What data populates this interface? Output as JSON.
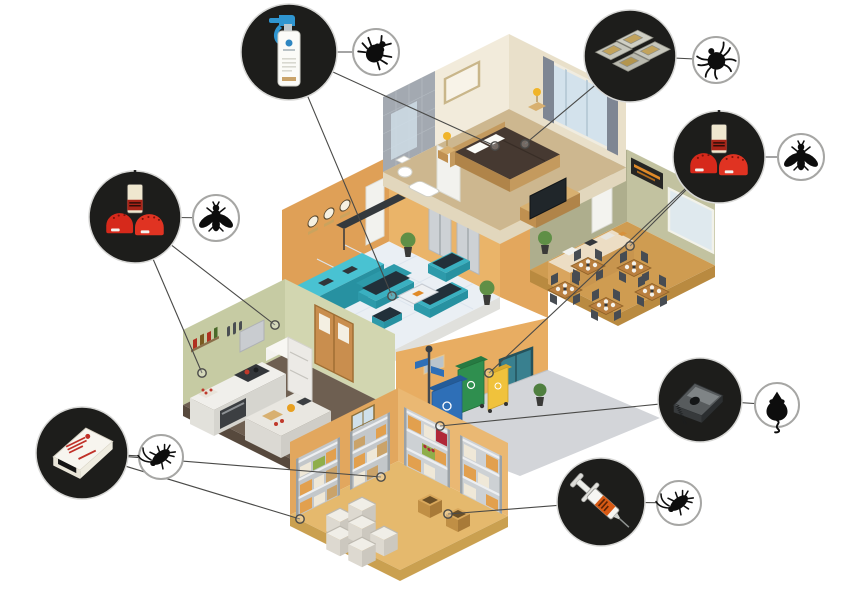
{
  "scene": {
    "kind": "isometric-pest-control-infographic",
    "background": "#ffffff",
    "line_color": "#4a4a48",
    "line_width": 1.1,
    "marker_radius": 4.2,
    "callout_style": {
      "fill": "#1d1d1b",
      "ring": "#d8d8d6",
      "ring_width": 1.5
    },
    "pest_circle_style": {
      "fill": "#ffffff",
      "stroke": "#a6a6a4",
      "stroke_width": 2,
      "glyph": "#0d0d0d"
    }
  },
  "callouts": [
    {
      "id": "bedbug-spray",
      "product": "spray",
      "product_name": "insecticide-trigger-spray-bottle",
      "pest": "bedbug",
      "pest_name": "bed-bug",
      "circle": {
        "cx": 289,
        "cy": 52,
        "r": 48
      },
      "pest_circle": {
        "cx": 376,
        "cy": 52,
        "r": 23
      },
      "targets": [
        [
          495,
          146
        ],
        [
          392,
          296
        ]
      ]
    },
    {
      "id": "bait-station-trays",
      "product": "trays",
      "product_name": "plastic-bait-station-traps",
      "pest": "tick",
      "pest_name": "tick-mite",
      "circle": {
        "cx": 630,
        "cy": 56,
        "r": 46
      },
      "pest_circle": {
        "cx": 716,
        "cy": 60,
        "r": 23
      },
      "targets": [
        [
          525,
          144
        ]
      ]
    },
    {
      "id": "fly-bait-right",
      "product": "flybait",
      "product_name": "fly-bait-bottle-and-red-stations",
      "pest": "fly",
      "pest_name": "fly",
      "circle": {
        "cx": 719,
        "cy": 157,
        "r": 46
      },
      "pest_circle": {
        "cx": 801,
        "cy": 157,
        "r": 23
      },
      "targets": [
        [
          630,
          246
        ],
        [
          489,
          373
        ]
      ]
    },
    {
      "id": "fly-bait-left",
      "product": "flybait",
      "product_name": "fly-bait-bottle-and-red-stations",
      "pest": "fly",
      "pest_name": "fly",
      "circle": {
        "cx": 135,
        "cy": 217,
        "r": 46
      },
      "pest_circle": {
        "cx": 216,
        "cy": 218,
        "r": 23
      },
      "targets": [
        [
          275,
          325
        ],
        [
          202,
          373
        ]
      ]
    },
    {
      "id": "roach-glue-trap",
      "product": "gluetrap",
      "product_name": "cardboard-glue-trap",
      "pest": "cockroach",
      "pest_name": "cockroach",
      "circle": {
        "cx": 82,
        "cy": 453,
        "r": 46
      },
      "pest_circle": {
        "cx": 161,
        "cy": 457,
        "r": 22
      },
      "targets": [
        [
          300,
          519
        ],
        [
          381,
          477
        ]
      ]
    },
    {
      "id": "mouse-bait-station",
      "product": "mousetrap",
      "product_name": "rodent-bait-station-trap",
      "pest": "mouse",
      "pest_name": "mouse",
      "circle": {
        "cx": 700,
        "cy": 400,
        "r": 42
      },
      "pest_circle": {
        "cx": 777,
        "cy": 405,
        "r": 22
      },
      "targets": [
        [
          440,
          426
        ]
      ]
    },
    {
      "id": "roach-gel-syringe",
      "product": "syringe",
      "product_name": "gel-bait-syringe",
      "pest": "cockroach",
      "pest_name": "cockroach",
      "circle": {
        "cx": 601,
        "cy": 502,
        "r": 44
      },
      "pest_circle": {
        "cx": 679,
        "cy": 503,
        "r": 22
      },
      "targets": [
        [
          448,
          514
        ]
      ]
    }
  ],
  "building": {
    "rooms": [
      {
        "id": "bedroom",
        "name": "hotel-bedroom-with-bathroom",
        "wall_colors": [
          "#f2ebdb",
          "#e9e0ca"
        ],
        "floor_color": "#cdb78f",
        "furniture": [
          "bed",
          "pillows",
          "nightstand-lamps",
          "tv",
          "picture-frame",
          "window-curtains",
          "shower",
          "toilet",
          "bathtub"
        ]
      },
      {
        "id": "restaurant",
        "name": "restaurant-dining-room",
        "wall_colors": [
          "#aeae8d",
          "#c2c2a0"
        ],
        "floor_color": "#cf9c51",
        "furniture": [
          "service-counter",
          "menu-sign",
          "window",
          "door",
          "dining-tables",
          "chairs",
          "plant"
        ]
      },
      {
        "id": "lobby",
        "name": "reception-lobby",
        "wall_colors": [
          "#dfa057",
          "#eab469"
        ],
        "floor_color": "#eaeff4",
        "furniture": [
          "reception-desk",
          "wall-clocks",
          "dark-canopy",
          "sofas",
          "coffee-table",
          "ottoman",
          "plants",
          "elevators"
        ]
      },
      {
        "id": "kitchen",
        "name": "commercial-kitchen",
        "wall_colors": [
          "#c6cba3",
          "#d2d6b0"
        ],
        "floor_color": "#6e5f51",
        "furniture": [
          "counter",
          "oven",
          "stove",
          "hood",
          "fridge",
          "island",
          "double-doors",
          "shelf-bottles"
        ]
      },
      {
        "id": "alley",
        "name": "waste-collection-alley",
        "wall_colors": [
          "#e8ad62"
        ],
        "floor_color": "#d3d5d9",
        "furniture": [
          "blue-bin",
          "green-bin",
          "yellow-bin",
          "lamp-post",
          "glass-door",
          "plant"
        ]
      },
      {
        "id": "storage",
        "name": "storage-warehouse-room",
        "wall_colors": [
          "#e2a75e",
          "#eab873"
        ],
        "floor_color": "#e5b96d",
        "furniture": [
          "shelving-racks",
          "boxes",
          "produce-crates",
          "cardboard-boxes",
          "window"
        ]
      }
    ],
    "accent_colors": {
      "teal": "#3ab0c0",
      "bin_blue": "#2e6fb7",
      "bin_green": "#2f8f4f",
      "bin_yellow": "#f0c23c",
      "bait_red": "#d6291b",
      "spray_blue": "#2f95d0",
      "syringe_orange": "#d85a14"
    }
  }
}
